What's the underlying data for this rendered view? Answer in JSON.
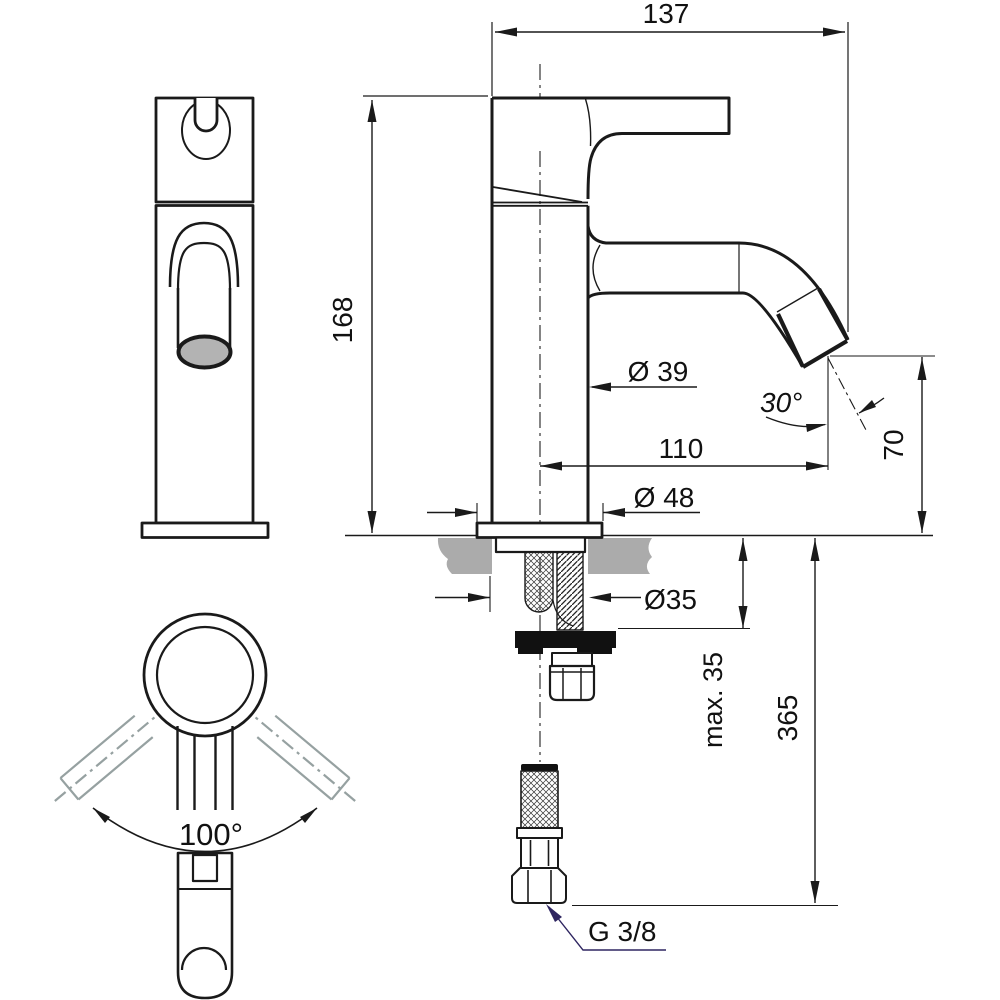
{
  "drawing": {
    "title": "Basin mixer technical dimension drawing",
    "views": {
      "front_view": "faucet front elevation",
      "plan_view": "faucet top view with handle swivel range",
      "side_view": "faucet side section with installation parts"
    },
    "dims": {
      "spout_width": "137",
      "total_height": "168",
      "body_diameter": "Ø 39",
      "spout_angle": "30°",
      "spout_reach": "110",
      "base_diameter": "Ø 48",
      "hole_diameter": "Ø35",
      "deck_thickness": "max. 35",
      "hose_length": "365",
      "outlet_height": "70",
      "thread_size": "G 3/8",
      "handle_swivel": "100°"
    },
    "colors": {
      "line_black": "#1a1a1a",
      "counter_gray": "#ababab",
      "outlet_gray": "#b3b3b3",
      "ghost_gray": "#96a1a1",
      "leader_navy": "#2e2560"
    }
  }
}
